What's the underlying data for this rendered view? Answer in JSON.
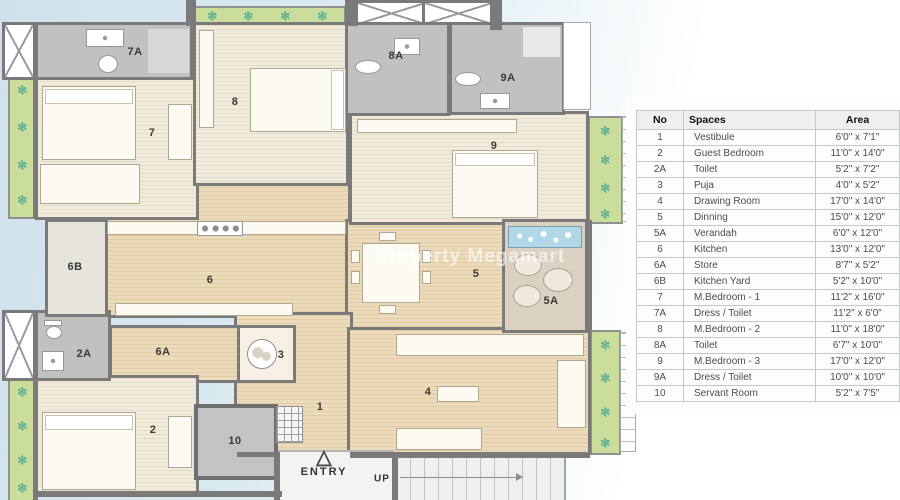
{
  "plan": {
    "watermark": "Property Megamart",
    "entry_label": "ENTRY",
    "up_label": "UP",
    "entry_arrow_glyph": "△",
    "plant_glyph": "✻",
    "room_labels": {
      "r1": "1",
      "r2": "2",
      "r2a": "2A",
      "r3": "3",
      "r4": "4",
      "r5": "5",
      "r5a": "5A",
      "r6": "6",
      "r6a": "6A",
      "r6b": "6B",
      "r7": "7",
      "r7a": "7A",
      "r8": "8",
      "r8a": "8A",
      "r9": "9",
      "r9a": "9A",
      "r10": "10"
    }
  },
  "table": {
    "columns": [
      "No",
      "Spaces",
      "Area"
    ],
    "rows": [
      [
        "1",
        "Vestibule",
        "6'0\" x 7'1\""
      ],
      [
        "2",
        "Guest Bedroom",
        "11'0\" x 14'0\""
      ],
      [
        "2A",
        "Toilet",
        "5'2\" x 7'2\""
      ],
      [
        "3",
        "Puja",
        "4'0\" x 5'2\""
      ],
      [
        "4",
        "Drawing Room",
        "17'0\" x 14'0\""
      ],
      [
        "5",
        "Dinning",
        "15'0\" x 12'0\""
      ],
      [
        "5A",
        "Verandah",
        "6'0\" x 12'0\""
      ],
      [
        "6",
        "Kitchen",
        "13'0\" x 12'0\""
      ],
      [
        "6A",
        "Store",
        "8'7\" x 5'2\""
      ],
      [
        "6B",
        "Kitchen Yard",
        "5'2\" x 10'0\""
      ],
      [
        "7",
        "M.Bedroom - 1",
        "11'2\" x 16'0\""
      ],
      [
        "7A",
        "Dress / Toilet",
        "11'2\" x 6'0\""
      ],
      [
        "8",
        "M.Bedroom - 2",
        "11'0\" x 18'0\""
      ],
      [
        "8A",
        "Toilet",
        "6'7\" x 10'0\""
      ],
      [
        "9",
        "M.Bedroom - 3",
        "17'0\" x 12'0\""
      ],
      [
        "9A",
        "Dress / Toilet",
        "10'0\" x 10'0\""
      ],
      [
        "10",
        "Servant Room",
        "5'2\" x 7'5\""
      ]
    ]
  },
  "colors": {
    "wall": "#7a7a7a",
    "floor_cream": "#f1ebdb",
    "floor_tan": "#ebdbba",
    "toilet_gray": "#c1c1c1",
    "planter_green": "#cbdd9b",
    "plant_teal": "#4fae93",
    "water_blue": "#b0d8e8",
    "background_blue": "#d3e4ec"
  }
}
